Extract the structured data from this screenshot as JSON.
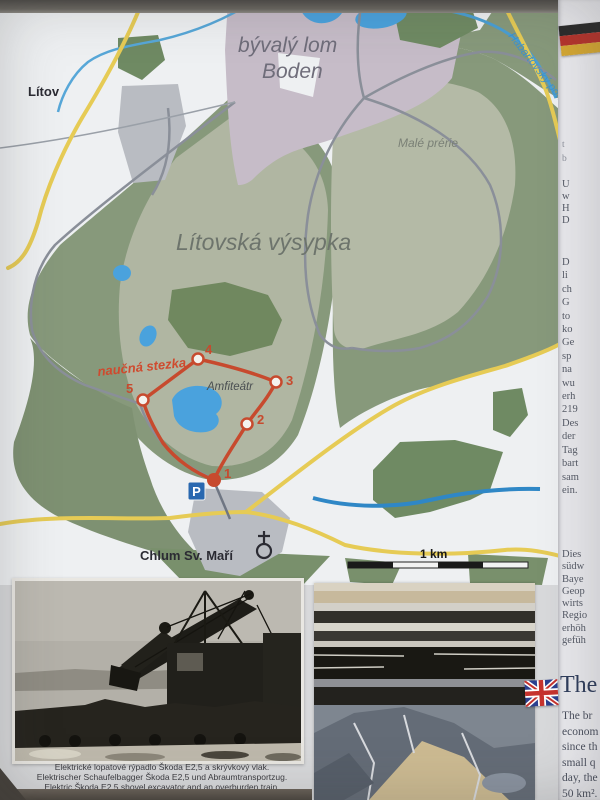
{
  "map": {
    "labels": {
      "litov": "Lítov",
      "boden_line1": "bývalý lom",
      "boden_line2": "Boden",
      "male_prerie": "Malé prérie",
      "vysypka": "Lítovská výsypka",
      "naucna_stezka": "naučná stezka",
      "amfiteatr": "Amfiteátr",
      "chlum": "Chlum Sv. Maří",
      "stream": "Habartovský potok",
      "scale": "1 km",
      "parking": "P"
    },
    "trail_points": [
      "1",
      "2",
      "3",
      "4",
      "5"
    ],
    "icons": {
      "church": "church-map-symbol",
      "parking": "parking-sign",
      "german_flag": "german-flag",
      "uk_flag": "uk-flag"
    },
    "colors": {
      "trail_red": "#c74a2e",
      "road_yellow": "#e6cb55",
      "road_gray": "#8a8f99",
      "water_blue": "#4aa2dd",
      "forest_green": "#87997b",
      "forest_dark": "#6f8a63",
      "spoil_light": "#b2b8a4",
      "quarry_purple": "#c6bcc8",
      "parking_blue": "#2968b0"
    }
  },
  "right_panel": {
    "fragments_top": [
      "t",
      "b"
    ],
    "fragments_a": [
      "U",
      "w",
      "H",
      "D"
    ],
    "fragments_b": [
      "D",
      "li",
      "ch",
      "G",
      "to",
      "ko",
      "Ge",
      "sp",
      "na",
      "wu",
      "erh",
      "219",
      "Des",
      "der",
      "Tag",
      "bart",
      "sam",
      "ein."
    ],
    "fragments_c": [
      "Dies",
      "südw",
      "Baye",
      "Geop",
      "wirts",
      "Regio",
      "erhöh",
      "gefüh"
    ],
    "english_heading": "The",
    "fragments_d": [
      "The br",
      "econom",
      "since th",
      "small q",
      "day, the",
      "50 km²."
    ]
  },
  "photos": {
    "left_caption_cs": "Elektrické lopatové rýpadlo Škoda E2,5 a skrývkový vlak.",
    "left_caption_de": "Elektrischer Schaufelbagger Škoda E2,5 und Abraumtransportzug.",
    "left_caption_en": "Elektric Škoda E2,5 shovel excavator and an overburden train."
  }
}
